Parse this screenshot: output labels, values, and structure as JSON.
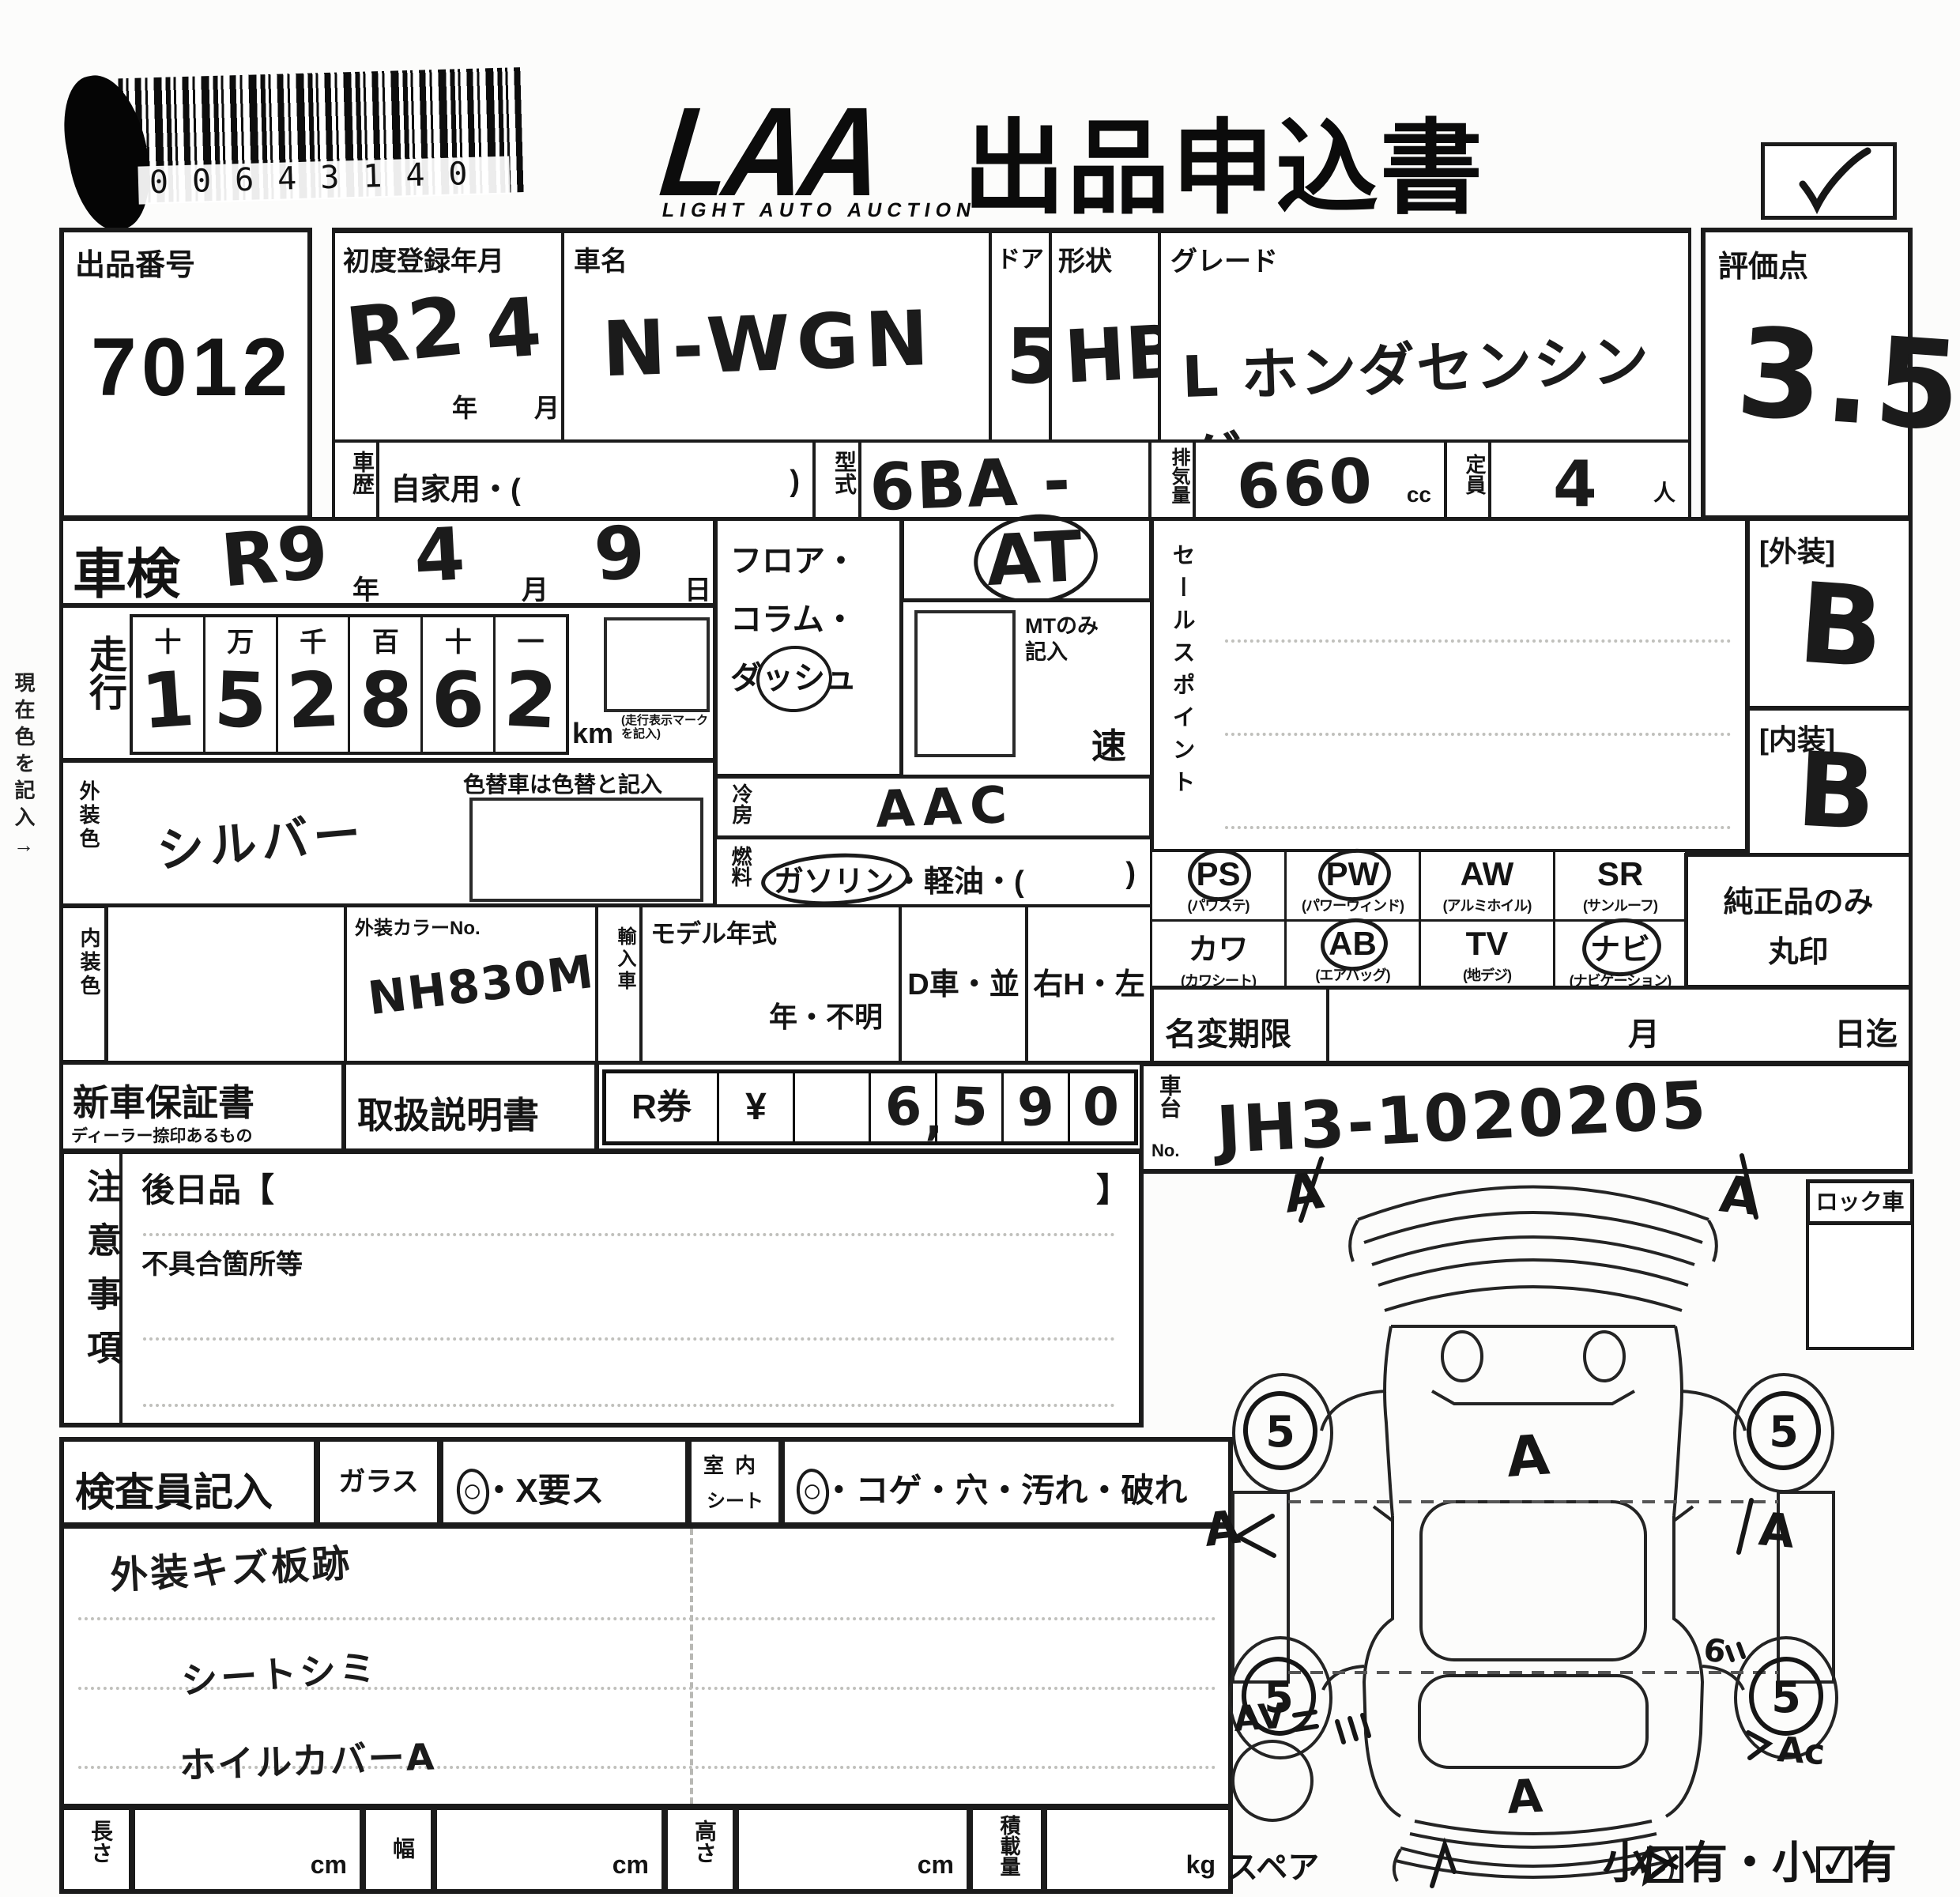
{
  "page": {
    "logo": "LAA",
    "logo_sub": "LIGHT AUTO AUCTION",
    "title": "出品申込書",
    "barcode_digits": "00643140",
    "checkbox_checked": true
  },
  "header": {
    "lot_label": "出品番号",
    "lot_no": "7012",
    "first_reg_label": "初度登録年月",
    "first_reg_era": "R2",
    "year_char": "年",
    "first_reg_month": "4",
    "month_char": "月",
    "car_name_label": "車名",
    "car_name": "N-WGN",
    "door_label": "ドア",
    "door": "5",
    "shape_label": "形状",
    "shape": "HB",
    "grade_label": "グレード",
    "grade": "L ホンダセンシング",
    "score_label": "評価点",
    "score": "3.5"
  },
  "row2": {
    "history_label": "車歴",
    "history_value": "自家用・(",
    "history_close": ")",
    "model_label": "型式",
    "model_code": "6BA - JH3",
    "disp_label": "排気量",
    "disp_value": "660",
    "disp_unit": "cc",
    "cap_label": "定員",
    "cap_value": "4",
    "cap_unit": "人"
  },
  "shaken": {
    "label": "車検",
    "era": "R9",
    "year_char": "年",
    "month": "4",
    "month_char": "月",
    "day": "9",
    "day_char": "日"
  },
  "mileage": {
    "label": "走行",
    "headers": [
      "十",
      "万",
      "千",
      "百",
      "十",
      "一"
    ],
    "digits": [
      "1",
      "5",
      "2",
      "8",
      "6",
      "2"
    ],
    "unit": "km",
    "note1": "(走行表示マーク",
    "note2": "を記入)"
  },
  "margin_note": "現在色を記入→",
  "ext_color": {
    "label": "外装色",
    "value": "シルバー",
    "recolor_note": "色替車は色替と記入"
  },
  "strip": {
    "int_label": "内装色",
    "color_no_label": "外装カラーNo.",
    "color_no": "NH830M",
    "import_label": "輸入車",
    "model_year_label": "モデル年式",
    "model_year": "年・不明",
    "d_car": "D車・並",
    "handle": "右H・左H"
  },
  "trans": {
    "line1": "フロア・",
    "line2": "コラム・",
    "line3a": "ダ",
    "line3b": "ッシ",
    "line3c": "ュ",
    "dash_circled": true,
    "value": "AT",
    "value_circled": true,
    "mt_note1": "MTのみ",
    "mt_note2": "記入",
    "speed": "速"
  },
  "ac": {
    "label": "冷房",
    "value": "AAC"
  },
  "fuel": {
    "label": "燃料",
    "opt1": "ガソリン",
    "opt1_circled": true,
    "rest": "・軽油・(",
    "close": ")"
  },
  "sales": {
    "label": "セールスポイント"
  },
  "grades": {
    "ext_label": "[外装]",
    "ext": "B",
    "int_label": "[内装]",
    "int": "B"
  },
  "equip": {
    "cells": [
      {
        "code": "PS",
        "sub": "(パワステ)",
        "circled": true
      },
      {
        "code": "PW",
        "sub": "(パワーウィンド)",
        "circled": true
      },
      {
        "code": "AW",
        "sub": "(アルミホイル)",
        "circled": false
      },
      {
        "code": "SR",
        "sub": "(サンルーフ)",
        "circled": false
      },
      {
        "code": "カワ",
        "sub": "(カワシート)",
        "circled": false
      },
      {
        "code": "AB",
        "sub": "(エアバッグ)",
        "circled": true
      },
      {
        "code": "TV",
        "sub": "(地デジ)",
        "circled": false
      },
      {
        "code": "ナビ",
        "sub": "(ナビゲーション)",
        "circled": true
      }
    ],
    "note1": "純正品のみ",
    "note2": "丸印"
  },
  "docs": {
    "warranty": "新車保証書",
    "warranty_sub": "ディーラー捺印あるもの",
    "manual": "取扱説明書",
    "ticket": "R券",
    "yen": "¥",
    "d1": "6",
    "comma": ",",
    "d2": "5",
    "d3": "9",
    "d4": "0"
  },
  "namechange": {
    "label": "名変期限",
    "month_char": "月",
    "until": "日迄"
  },
  "chassis": {
    "label_top": "車台",
    "label_no": "No.",
    "value": "JH3-1020205"
  },
  "notes": {
    "label": "注意事項",
    "later": "後日品【",
    "later_close": "】",
    "defects": "不具合箇所等"
  },
  "inspector": {
    "label": "検査員記入",
    "glass_label": "ガラス",
    "glass_circle": "○",
    "glass_circled": true,
    "glass_rest": "・X要ス",
    "seat_label1": "室内",
    "seat_label2": "シート",
    "seat_circle": "○",
    "seat_circled": true,
    "seat_rest": "・コゲ・穴・汚れ・破れ",
    "note1": "外装キズ板跡",
    "note2": "シートシミ",
    "note3": "ホイルカバーA"
  },
  "measures": {
    "len": "長さ",
    "wid": "幅",
    "hei": "高さ",
    "load": "積載量",
    "cm": "cm",
    "kg": "kg"
  },
  "diagram": {
    "lock": "ロック車",
    "spare": "スペア",
    "wheel": "5",
    "ann_front_left": "A",
    "ann_front_right": "A",
    "ann_hood": "A",
    "ann_side_left": "A",
    "ann_side_right": "A",
    "ann_rear_left": "AV",
    "ann_rear_right": "Ac",
    "ann_trunk": "A",
    "ann_six": "6",
    "small_prefix": "小",
    "small_mid": "有・小",
    "small_suffix": "有"
  }
}
